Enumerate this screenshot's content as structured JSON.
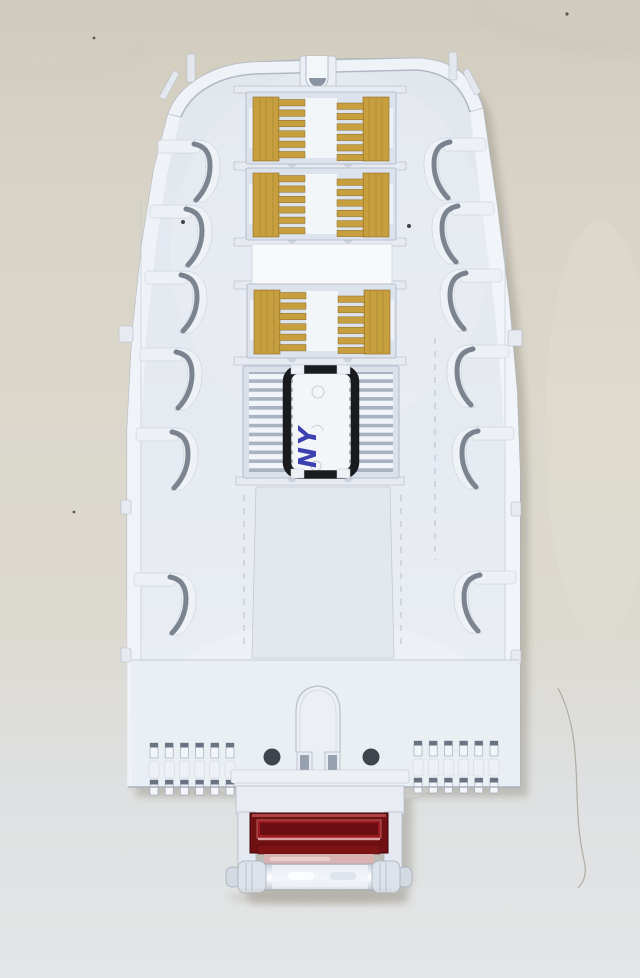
{
  "scene": {
    "alt": "White plastic fiber-optic splice tray on cream fabric, three yellow splice-holder combs, a splice block wrapped with black bands hand-labeled NY, and a dark red hinged latch at the bottom",
    "label_text": "NY",
    "colors": {
      "fabric_top": "#d2cdc0",
      "fabric_bottom": "#e2e4e5",
      "tray_plastic": "#e7ebf2",
      "tray_outline": "#a9b2bf",
      "comb_yellow": "#c79f3e",
      "comb_yellow_shadow": "#8a6a26",
      "retainer_band_black": "#1a1b1e",
      "label_blue": "#3c40b0",
      "latch_red": "#701013",
      "latch_red_inner": "#9c191e",
      "hinge_pink": "#d9b3b1",
      "hole_dark": "#40454d"
    }
  }
}
